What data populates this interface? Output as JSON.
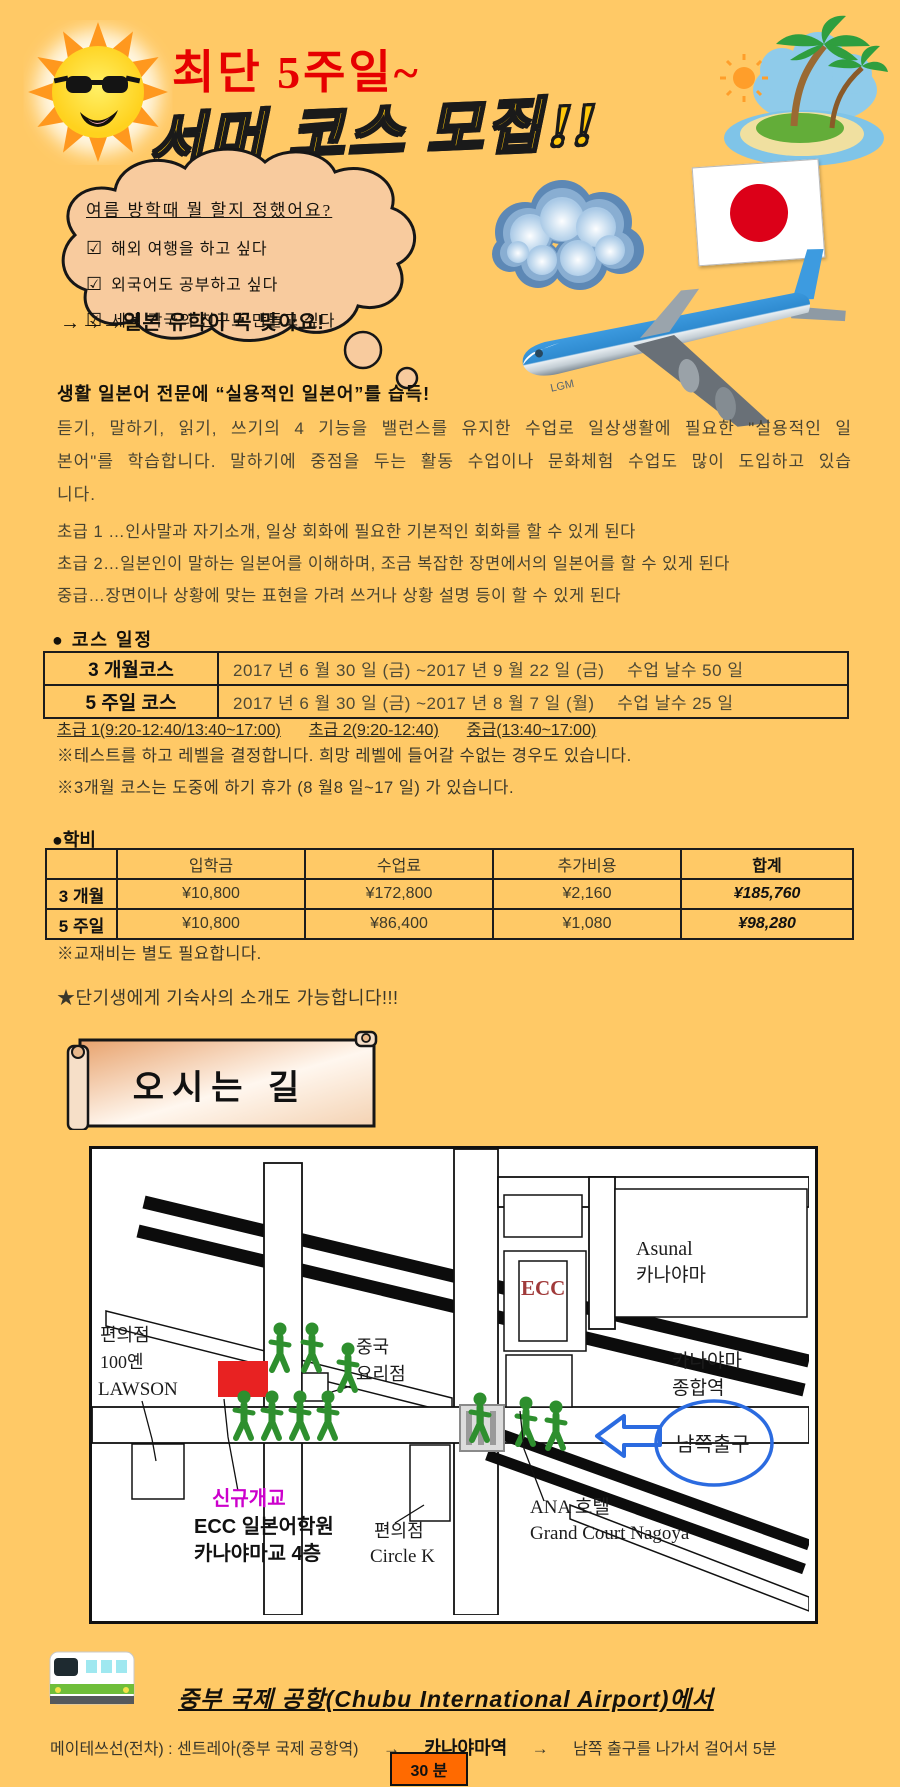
{
  "colors": {
    "background": "#FFC966",
    "title_red": "#E60000",
    "title_yellow": "#FFC80A",
    "map_school_red": "#E82222",
    "walker_green": "#2E8F2E",
    "route_blue": "#2B6BE0",
    "badge_orange": "#FF6A00",
    "flag_red": "#DC0018"
  },
  "header": {
    "red_title": "최단 5주일~",
    "main_title": "서머 코스 모집!!",
    "plane_label": "LGM",
    "bubble": {
      "question": "여름 방학때 뭘 할지 정했어요?",
      "checkbox": "☑",
      "items": [
        "해외  여행을 하고 싶다",
        "외국어도 공부하고  싶다",
        "세계 각국의 친구도 만들고 싶다"
      ],
      "conclusion": "→→→일본 유학이 꼭 맞아요!"
    }
  },
  "intro": {
    "heading": "생활 일본어 전문에 “실용적인 일본어”를 습득!",
    "paragraph": "듣기, 말하기, 읽기, 쓰기의 4 기능을 밸런스를 유지한 수업로 일상생활에 필요한 \"실용적인 일본어\"를 학습합니다. 말하기에 중점을 두는 활동 수업이나 문화체험 수업도 많이 도입하고 있습니다.",
    "levels": [
      "초급 1 …인사말과 자기소개, 일상 회화에 필요한 기본적인 회화를 할 수 있게 된다",
      "초급 2…일본인이 말하는 일본어를 이해하며, 조금 복잡한 장면에서의 일본어를 할 수 있게 된다",
      "중급…장면이나 상황에 맞는 표현을 가려 쓰거나 상황 설명 등이 할 수 있게 된다"
    ]
  },
  "schedule": {
    "heading": "● 코스  일정",
    "rows": [
      {
        "course": "3 개월코스",
        "period": "2017 년 6 월 30 일 (금) ~2017 년 9 월 22 일 (금)　 수업 날수 50 일"
      },
      {
        "course": "5 주일 코스",
        "period": "2017 년 6 월 30 일 (금) ~2017 년 8 월 7 일 (월)　 수업 날수 25 일"
      }
    ],
    "times": [
      "초급 1(9:20-12:40/13:40~17:00)",
      "초급 2(9:20-12:40)",
      "중급(13:40~17:00)"
    ],
    "notes": [
      "※테스트를 하고 레벨을  결정합니다. 희망 레벨에 들어갈 수없는 경우도 있습니다.",
      "※3개월 코스는 도중에 하기 휴가 (8 월8 일~17 일) 가 있습니다."
    ]
  },
  "fees": {
    "heading": "●학비",
    "columns": [
      "",
      "입학금",
      "수업료",
      "추가비용",
      "합계"
    ],
    "rows": [
      {
        "label": "3 개월",
        "entry": "¥10,800",
        "tuition": "¥172,800",
        "extra": "¥2,160",
        "total": "¥185,760"
      },
      {
        "label": "5 주일",
        "entry": "¥10,800",
        "tuition": "¥86,400",
        "extra": "¥1,080",
        "total": "¥98,280"
      }
    ],
    "note": "※교재비는 별도 필요합니다.",
    "dorm_note": "★단기생에게 기숙사의 소개도 가능합니다!!!"
  },
  "directions": {
    "banner": "오시는 길",
    "map": {
      "ecc": "ECC",
      "asunal_1": "Asunal",
      "asunal_2": "카나야마",
      "station_1": "카나야마",
      "station_2": "종합역",
      "lawson_1": "편의점",
      "lawson_2": "100옌",
      "lawson_3": "LAWSON",
      "chinese_1": "중국",
      "chinese_2": "요리점",
      "south_exit": "남쪽출구",
      "ana_1": "ANA 호텔",
      "ana_2": "Grand Court Nagoya",
      "circlek_1": "편의점",
      "circlek_2": "Circle K",
      "school_1": "신규개교",
      "school_2": "ECC 일본어학원",
      "school_3": "카나야마교 4층"
    },
    "train_heading": "중부 국제 공항(Chubu International Airport)에서",
    "route": {
      "part1": "메이테쓰선(전차) : 센트레아(중부 국제 공항역)",
      "arrow": "→",
      "station": "카나야마역",
      "part2": "남쪽 출구를 나가서 걸어서 5분"
    },
    "duration_badge": "30 분"
  }
}
